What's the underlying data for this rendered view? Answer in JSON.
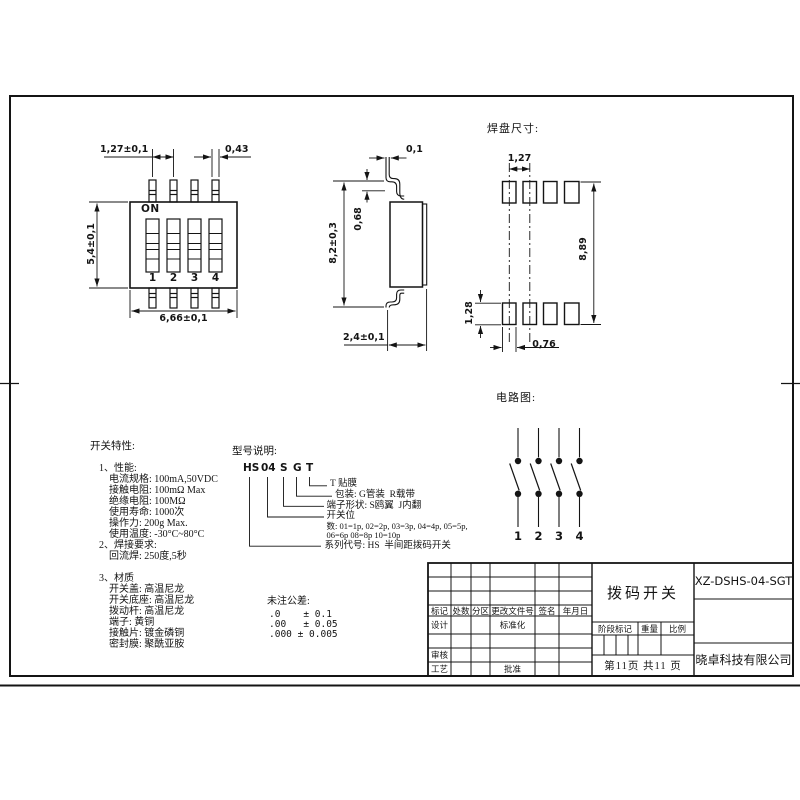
{
  "front_view": {
    "on_label": "ON",
    "positions": [
      "1",
      "2",
      "3",
      "4"
    ],
    "dim_pitch": "1,27±0,1",
    "dim_pin_width": "0,43",
    "dim_body_height": "5,4±0,1",
    "dim_body_width": "6,66±0,1"
  },
  "side_view": {
    "dim_lead_thickness": "0,1",
    "dim_standoff": "0,68",
    "dim_total_height": "8,2±0,3",
    "dim_depth": "2,4±0,1"
  },
  "pad_layout": {
    "title": "焊盘尺寸:",
    "dim_pitch": "1,27",
    "dim_span": "8,89",
    "dim_pad_height": "1,28",
    "dim_pad_width": "0,76"
  },
  "circuit": {
    "title": "电路图:",
    "positions": [
      "1",
      "2",
      "3",
      "4"
    ]
  },
  "characteristics": {
    "title": "开关特性:",
    "lines": [
      "1、性能:",
      "电流规格: 100mA,50VDC",
      "接触电阻: 100mΩ Max",
      "绝缘电阻: 100MΩ",
      "使用寿命: 1000次",
      "操作力: 200g Max.",
      "使用温度: -30°C~80°C",
      "2、焊接要求:",
      "回流焊: 250度,5秒",
      "3、材质",
      "开关盖: 高温尼龙",
      "开关底座: 高温尼龙",
      "拨动杆: 高温尼龙",
      "端子: 黄铜",
      "接触片: 镀金磷铜",
      "密封膜: 聚酰亚胺"
    ]
  },
  "model": {
    "title": "型号说明:",
    "code": [
      "HS",
      "04",
      "S",
      "G",
      "T"
    ],
    "legend": [
      "T 贴膜",
      "包装: G管装  R载带",
      "端子形状: S鸥翼  J内翻",
      "开关位",
      "数: 01=1p, 02=2p, 03=3p, 04=4p, 05=5p,",
      "06=6p 08=8p 10=10p",
      "系列代号: HS  半间距拨码开关"
    ]
  },
  "tolerance": {
    "title": "未注公差:",
    "rows": [
      ".0    ± 0.1",
      ".00   ± 0.05",
      ".000 ± 0.005"
    ]
  },
  "title_block": {
    "rev_headers": [
      "标记",
      "处数",
      "分区",
      "更改文件号",
      "签名",
      "年月日"
    ],
    "design_label": "设计",
    "standardization_label": "标准化",
    "check_label": "审核",
    "process_label": "工艺",
    "approve_label": "批准",
    "stage_label": "阶段标记",
    "weight_label": "重量",
    "scale_label": "比例",
    "product_name": "拨码开关",
    "part_number": "XZ-DSHS-04-SGT",
    "company": "晓卓科技有限公司",
    "page_info": "第11页 共11 页"
  }
}
